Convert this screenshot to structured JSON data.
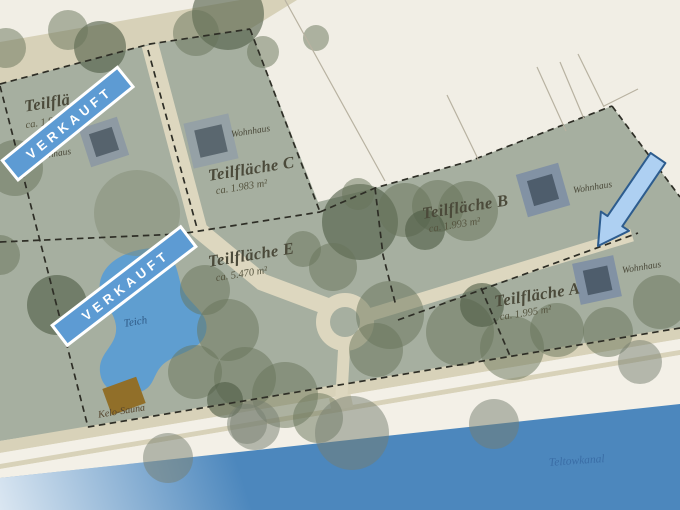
{
  "site_plan": {
    "sold_label": "VERKAUFT",
    "plots": [
      {
        "id": "C",
        "name": "Teilfläche C",
        "area": "ca. 1.983 m²",
        "house_label": "Wohnhaus"
      },
      {
        "id": "B",
        "name": "Teilfläche B",
        "area": "ca. 1.993 m²",
        "house_label": "Wohnhaus"
      },
      {
        "id": "A",
        "name": "Teilfläche A",
        "area": "ca. 1.995 m²",
        "house_label": "Wohnhaus"
      },
      {
        "id": "E",
        "name": "Teilfläche E",
        "area": "ca. 5.470 m²"
      },
      {
        "id": "sold-plot",
        "name": "Teilflä",
        "area": "ca. 1.9",
        "house_label": "Wohnhaus",
        "status": "VERKAUFT"
      }
    ],
    "features": {
      "pond_label": "Teich",
      "sauna_label": "Kelo-Sauna",
      "canal_label": "Teltowkanal"
    },
    "colors": {
      "plot_green": "#a6afa0",
      "road_beige": "#d7d1b8",
      "water_blue": "#4c87bd",
      "pond_blue": "#5f9ed0",
      "banner_blue": "#5d9bd3",
      "arrow_fill": "#aed0f2",
      "arrow_stroke": "#2d5c8e"
    }
  }
}
